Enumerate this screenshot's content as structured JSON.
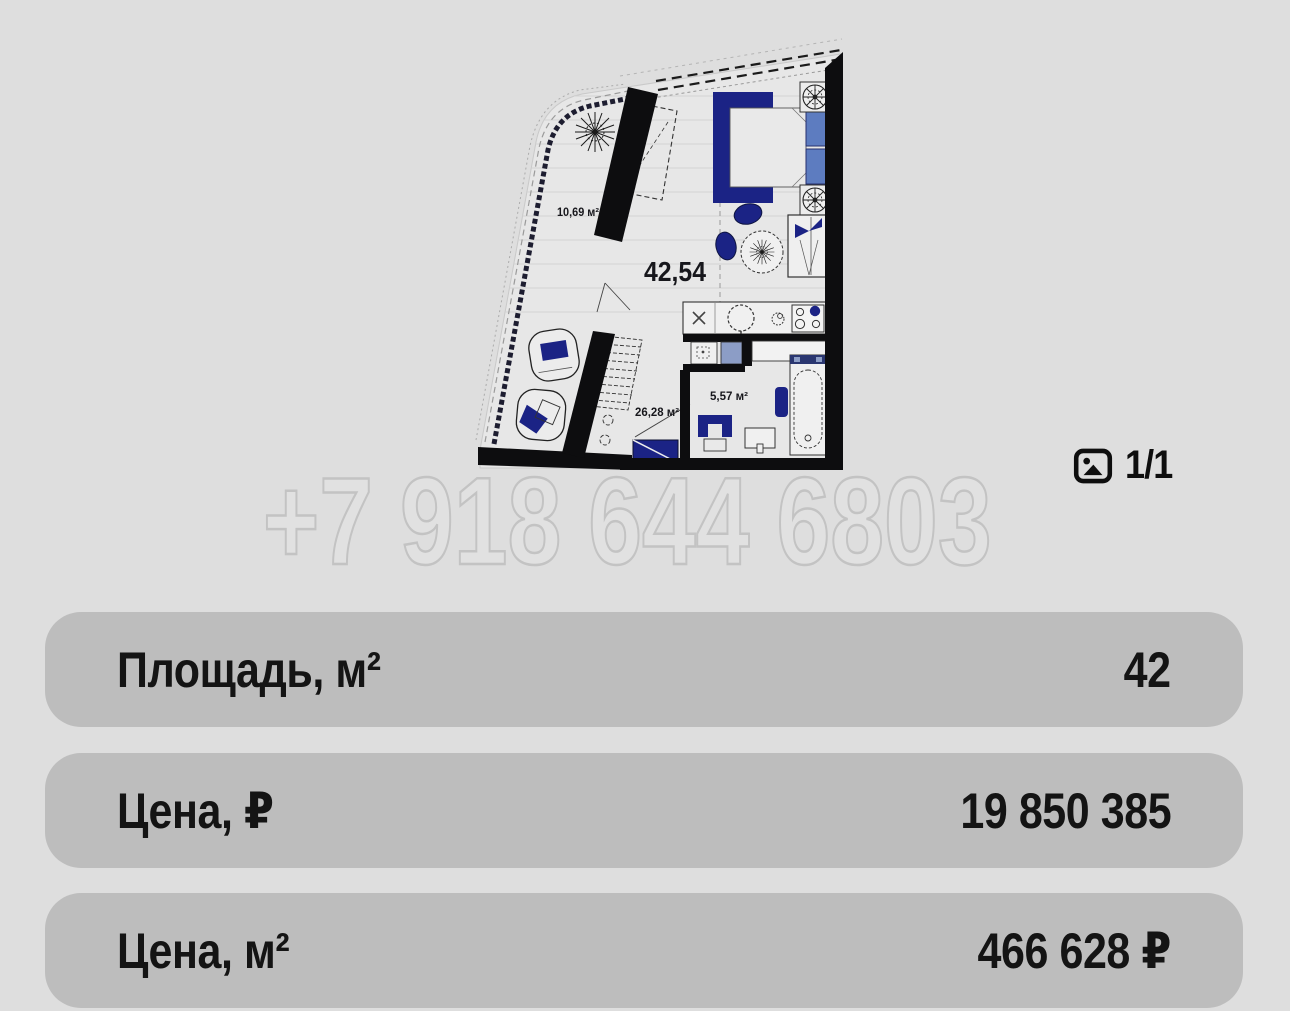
{
  "page": {
    "background": "#dedede",
    "card_background": "#bdbdbd",
    "text_color": "#141414"
  },
  "floor_plan": {
    "total_area_label": "42,54",
    "balcony_area_label": "10,69 м²",
    "room_area_label": "26,28 м²",
    "bathroom_area_label": "5,57 м²",
    "colors": {
      "walls": "#0d0d0f",
      "furniture_navy": "#1b2385",
      "pillows_blue": "#5d7cc0",
      "washer_blue": "#8c9dc6",
      "paper": "#e7e7e7"
    }
  },
  "watermark": {
    "text": "+7 918 644 6803",
    "fill": "#e1e1e1",
    "outline": "#c3c3c3"
  },
  "gallery": {
    "counter": "1/1"
  },
  "info_rows": [
    {
      "label": "Площадь, м²",
      "value": "42"
    },
    {
      "label": "Цена, ₽",
      "value": "19 850 385"
    },
    {
      "label": "Цена, м²",
      "value": "466 628 ₽"
    }
  ]
}
